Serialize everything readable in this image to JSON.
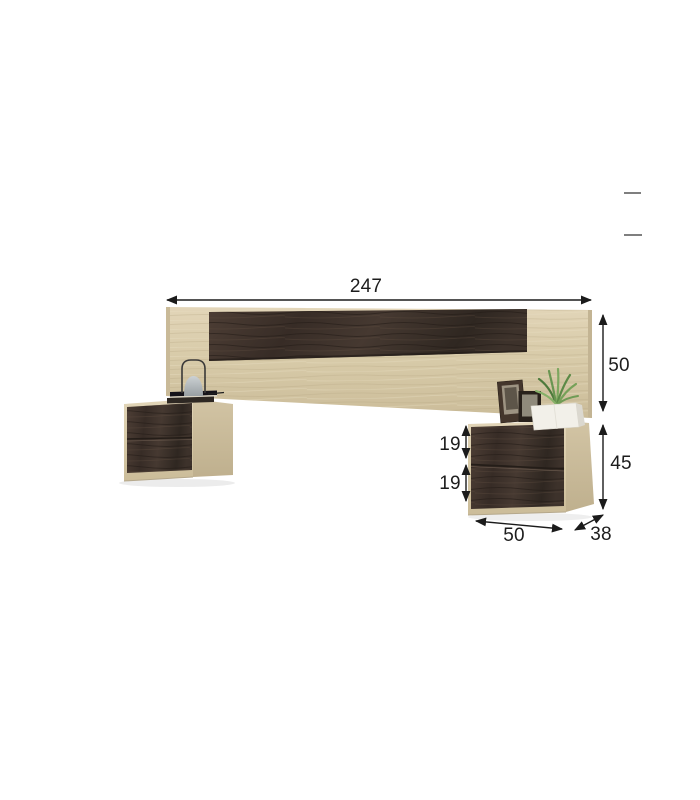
{
  "diagram": {
    "kind": "furniture-dimension-diagram",
    "dimension_labels": {
      "headboard_width": "247",
      "headboard_height": "50",
      "nightstand_total_height": "45",
      "nightstand_top_drawer_height": "19",
      "nightstand_bottom_drawer_height": "19",
      "nightstand_width": "50",
      "nightstand_depth": "38"
    },
    "colors": {
      "background": "#ffffff",
      "light_wood": "#d6c8a7",
      "light_wood_side": "#c7b896",
      "dark_wood": "#42352d",
      "dimension_ink": "#1c1c1c",
      "plant_green": "#6f9b55",
      "lamp_shade_gray": "#b2b8bb",
      "artifact_dash_gray": "#7f7f7f"
    }
  }
}
